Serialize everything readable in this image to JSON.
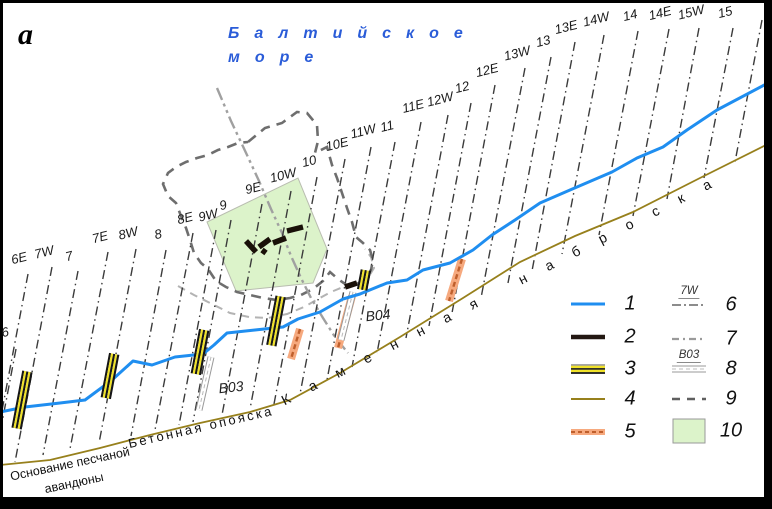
{
  "figure_label": "a",
  "sea_title": {
    "line1": "Балтийское",
    "line2": "море",
    "color": "#2a5cd8"
  },
  "map": {
    "profile_lines": [
      {
        "label": "6",
        "lx": 5,
        "ly": 332,
        "x1": 16,
        "y1": 349,
        "x2": 0,
        "y2": 433
      },
      {
        "label": "6E",
        "lx": 19,
        "ly": 258,
        "x1": 28,
        "y1": 274,
        "x2": 0,
        "y2": 421
      },
      {
        "label": "7W",
        "lx": 44,
        "ly": 252,
        "x1": 52,
        "y1": 267,
        "x2": 15,
        "y2": 462
      },
      {
        "label": "7",
        "lx": 69,
        "ly": 256,
        "x1": 78,
        "y1": 271,
        "x2": 43,
        "y2": 455
      },
      {
        "label": "7E",
        "lx": 100,
        "ly": 237,
        "x1": 108,
        "y1": 252,
        "x2": 70,
        "y2": 449
      },
      {
        "label": "8W",
        "lx": 128,
        "ly": 233,
        "x1": 136,
        "y1": 249,
        "x2": 99,
        "y2": 443
      },
      {
        "label": "8",
        "lx": 158,
        "ly": 234,
        "x1": 166,
        "y1": 250,
        "x2": 131,
        "y2": 436
      },
      {
        "label": "8E",
        "lx": 185,
        "ly": 218,
        "x1": 193,
        "y1": 233,
        "x2": 155,
        "y2": 430
      },
      {
        "label": "9W",
        "lx": 208,
        "ly": 215,
        "x1": 216,
        "y1": 230,
        "x2": 179,
        "y2": 425
      },
      {
        "label": "9",
        "lx": 223,
        "ly": 205,
        "x1": 231,
        "y1": 220,
        "x2": 193,
        "y2": 422
      },
      {
        "label": "9E",
        "lx": 253,
        "ly": 188,
        "x1": 262,
        "y1": 204,
        "x2": 222,
        "y2": 415
      },
      {
        "label": "10W",
        "lx": 283,
        "ly": 175,
        "x1": 291,
        "y1": 191,
        "x2": 250,
        "y2": 409
      },
      {
        "label": "10",
        "lx": 309,
        "ly": 161,
        "x1": 317,
        "y1": 177,
        "x2": 274,
        "y2": 404
      },
      {
        "label": "10E",
        "lx": 337,
        "ly": 144,
        "x1": 345,
        "y1": 159,
        "x2": 300,
        "y2": 394
      },
      {
        "label": "11W",
        "lx": 363,
        "ly": 131,
        "x1": 371,
        "y1": 147,
        "x2": 327,
        "y2": 380
      },
      {
        "label": "11",
        "lx": 387,
        "ly": 126,
        "x1": 395,
        "y1": 142,
        "x2": 352,
        "y2": 367
      },
      {
        "label": "11E",
        "lx": 413,
        "ly": 106,
        "x1": 421,
        "y1": 122,
        "x2": 377,
        "y2": 353
      },
      {
        "label": "12W",
        "lx": 440,
        "ly": 99,
        "x1": 448,
        "y1": 115,
        "x2": 406,
        "y2": 338
      },
      {
        "label": "12",
        "lx": 462,
        "ly": 87,
        "x1": 471,
        "y1": 103,
        "x2": 429,
        "y2": 326
      },
      {
        "label": "12E",
        "lx": 487,
        "ly": 70,
        "x1": 495,
        "y1": 85,
        "x2": 452,
        "y2": 313
      },
      {
        "label": "13W",
        "lx": 517,
        "ly": 53,
        "x1": 525,
        "y1": 68,
        "x2": 481,
        "y2": 298
      },
      {
        "label": "13",
        "lx": 543,
        "ly": 41,
        "x1": 551,
        "y1": 57,
        "x2": 508,
        "y2": 283
      },
      {
        "label": "13E",
        "lx": 566,
        "ly": 27,
        "x1": 575,
        "y1": 42,
        "x2": 532,
        "y2": 271
      },
      {
        "label": "14W",
        "lx": 596,
        "ly": 19,
        "x1": 604,
        "y1": 35,
        "x2": 562,
        "y2": 254
      },
      {
        "label": "14",
        "lx": 630,
        "ly": 15,
        "x1": 638,
        "y1": 31,
        "x2": 599,
        "y2": 235
      },
      {
        "label": "14E",
        "lx": 660,
        "ly": 13,
        "x1": 669,
        "y1": 29,
        "x2": 633,
        "y2": 216
      },
      {
        "label": "15W",
        "lx": 691,
        "ly": 12,
        "x1": 699,
        "y1": 28,
        "x2": 667,
        "y2": 199
      },
      {
        "label": "15",
        "lx": 725,
        "ly": 12,
        "x1": 733,
        "y1": 28,
        "x2": 704,
        "y2": 178
      },
      {
        "label": "",
        "lx": 762,
        "ly": 8,
        "x1": 762,
        "y1": 20,
        "x2": 735,
        "y2": 162
      }
    ],
    "blue_line": [
      [
        0,
        412
      ],
      [
        25,
        407
      ],
      [
        60,
        403
      ],
      [
        85,
        400
      ],
      [
        112,
        380
      ],
      [
        133,
        361
      ],
      [
        152,
        365
      ],
      [
        175,
        357
      ],
      [
        203,
        354
      ],
      [
        214,
        345
      ],
      [
        227,
        333
      ],
      [
        255,
        330
      ],
      [
        283,
        327
      ],
      [
        298,
        319
      ],
      [
        320,
        312
      ],
      [
        343,
        299
      ],
      [
        360,
        294
      ],
      [
        387,
        283
      ],
      [
        407,
        280
      ],
      [
        423,
        270
      ],
      [
        450,
        263
      ],
      [
        473,
        250
      ],
      [
        492,
        235
      ],
      [
        515,
        220
      ],
      [
        540,
        203
      ],
      [
        570,
        190
      ],
      [
        612,
        172
      ],
      [
        637,
        158
      ],
      [
        663,
        147
      ],
      [
        687,
        130
      ],
      [
        717,
        110
      ],
      [
        770,
        82
      ]
    ],
    "olive_line": [
      [
        0,
        465
      ],
      [
        50,
        460
      ],
      [
        100,
        448
      ],
      [
        150,
        435
      ],
      [
        200,
        423
      ],
      [
        250,
        412
      ],
      [
        290,
        400
      ],
      [
        340,
        373
      ],
      [
        400,
        337
      ],
      [
        463,
        298
      ],
      [
        520,
        262
      ],
      [
        575,
        236
      ],
      [
        633,
        212
      ],
      [
        700,
        178
      ],
      [
        770,
        143
      ]
    ],
    "gray_center_line": [
      [
        217,
        88
      ],
      [
        231,
        121
      ],
      [
        247,
        155
      ],
      [
        259,
        181
      ],
      [
        271,
        209
      ],
      [
        282,
        233
      ],
      [
        291,
        256
      ],
      [
        301,
        278
      ],
      [
        311,
        298
      ],
      [
        323,
        318
      ],
      [
        335,
        337
      ],
      [
        348,
        353
      ]
    ],
    "dashed_loop": [
      [
        248,
        142
      ],
      [
        265,
        128
      ],
      [
        282,
        123
      ],
      [
        297,
        112
      ],
      [
        307,
        113
      ],
      [
        317,
        125
      ],
      [
        318,
        141
      ],
      [
        315,
        153
      ],
      [
        327,
        147
      ],
      [
        332,
        165
      ],
      [
        337,
        178
      ],
      [
        342,
        193
      ],
      [
        347,
        208
      ],
      [
        352,
        222
      ],
      [
        356,
        237
      ],
      [
        363,
        243
      ],
      [
        370,
        250
      ],
      [
        373,
        260
      ],
      [
        371,
        270
      ],
      [
        366,
        278
      ],
      [
        357,
        284
      ],
      [
        348,
        286
      ],
      [
        338,
        279
      ],
      [
        330,
        272
      ],
      [
        323,
        281
      ],
      [
        313,
        289
      ],
      [
        301,
        295
      ],
      [
        290,
        298
      ],
      [
        277,
        300
      ],
      [
        263,
        298
      ],
      [
        250,
        295
      ],
      [
        237,
        292
      ],
      [
        226,
        287
      ],
      [
        216,
        281
      ],
      [
        208,
        269
      ],
      [
        201,
        263
      ],
      [
        194,
        253
      ],
      [
        190,
        240
      ],
      [
        186,
        228
      ],
      [
        181,
        216
      ],
      [
        176,
        203
      ],
      [
        168,
        196
      ],
      [
        163,
        184
      ],
      [
        168,
        173
      ],
      [
        176,
        167
      ],
      [
        186,
        162
      ],
      [
        197,
        158
      ],
      [
        208,
        155
      ],
      [
        218,
        150
      ],
      [
        228,
        147
      ],
      [
        238,
        143
      ],
      [
        248,
        142
      ]
    ],
    "light_dashed_line": [
      [
        178,
        286
      ],
      [
        194,
        295
      ],
      [
        212,
        304
      ],
      [
        230,
        313
      ],
      [
        249,
        317
      ],
      [
        268,
        318
      ],
      [
        287,
        314
      ],
      [
        304,
        307
      ],
      [
        318,
        299
      ],
      [
        331,
        292
      ],
      [
        343,
        287
      ],
      [
        356,
        283
      ],
      [
        368,
        278
      ],
      [
        374,
        268
      ],
      [
        371,
        257
      ],
      [
        365,
        249
      ]
    ],
    "green_polygon": [
      [
        207,
        222
      ],
      [
        298,
        178
      ],
      [
        327,
        249
      ],
      [
        313,
        283
      ],
      [
        236,
        291
      ]
    ],
    "black_dashes": [
      [
        246,
        241,
        256,
        252
      ],
      [
        259,
        247,
        270,
        239
      ],
      [
        262,
        250,
        266,
        253
      ],
      [
        273,
        243,
        286,
        238
      ],
      [
        287,
        231,
        303,
        227
      ],
      [
        345,
        287,
        357,
        283
      ]
    ],
    "striped_markers": [
      {
        "cx": 22,
        "cy": 400,
        "len": 58
      },
      {
        "cx": 110,
        "cy": 376,
        "len": 45
      },
      {
        "cx": 200,
        "cy": 352,
        "len": 45
      },
      {
        "cx": 276,
        "cy": 321,
        "len": 50
      },
      {
        "cx": 364,
        "cy": 280,
        "len": 20
      }
    ],
    "orange_bands": [
      {
        "x1": 300,
        "y1": 329,
        "x2": 291,
        "y2": 359
      },
      {
        "x1": 352,
        "y1": 296,
        "x2": 338,
        "y2": 348
      },
      {
        "x1": 462,
        "y1": 259,
        "x2": 449,
        "y2": 301
      }
    ],
    "boreholes": [
      {
        "x1": 211,
        "y1": 357,
        "x2": 199,
        "y2": 410,
        "label": "B03",
        "label_x": 231,
        "label_y": 387
      },
      {
        "x1": 353,
        "y1": 292,
        "x2": 341,
        "y2": 340,
        "label": "B04",
        "label_x": 378,
        "label_y": 315
      }
    ],
    "coast_labels": [
      {
        "id": "kamennaya-label",
        "text": "Каменная наброска",
        "cx": 506,
        "cy": 287,
        "rotate": -27,
        "spacing": 22,
        "size": 14
      },
      {
        "id": "betonnaya-label",
        "text": "Бетонная опояска",
        "cx": 201,
        "cy": 427,
        "rotate": -13,
        "spacing": 2.5,
        "size": 13
      },
      {
        "id": "osnovanie-label-1",
        "text": "Основание песчаной",
        "cx": 70,
        "cy": 464,
        "rotate": -12,
        "spacing": 0,
        "size": 12.5
      },
      {
        "id": "osnovanie-label-2",
        "text": "авандюны",
        "cx": 74,
        "cy": 483,
        "rotate": -12,
        "spacing": 0,
        "size": 12.5
      }
    ]
  },
  "legend": {
    "items": [
      {
        "num": "1",
        "type": "blue-line",
        "x": 588,
        "y": 304
      },
      {
        "num": "2",
        "type": "black-dash",
        "x": 588,
        "y": 337
      },
      {
        "num": "3",
        "type": "striped-band",
        "x": 588,
        "y": 369
      },
      {
        "num": "4",
        "type": "olive-line",
        "x": 588,
        "y": 399
      },
      {
        "num": "5",
        "type": "orange-band",
        "x": 588,
        "y": 432
      },
      {
        "num": "6",
        "type": "profile-line",
        "sublabel": "7W",
        "x": 689,
        "y": 305
      },
      {
        "num": "7",
        "type": "gray-dashed",
        "x": 689,
        "y": 339
      },
      {
        "num": "8",
        "type": "borehole",
        "sublabel": "B03",
        "x": 689,
        "y": 369
      },
      {
        "num": "9",
        "type": "dark-dashed",
        "x": 689,
        "y": 399
      },
      {
        "num": "10",
        "type": "green-area",
        "x": 689,
        "y": 431
      }
    ]
  },
  "colors": {
    "sea_line": "#1f8ef0",
    "rock_line": "#97801c",
    "profile_line": "#3b3b3b",
    "loop": "#6e6e6e",
    "light_dashed": "#b3b3b3",
    "gray_center": "#a0a0a0",
    "green_fill": "#dcf3ca",
    "green_stroke": "#b9bdb0",
    "orange_fill": "#f6a97e",
    "orange_dash": "#bf5f2c",
    "marker_yellow": "#f0e229",
    "marker_black": "#161616",
    "black_dash": "#191008",
    "borehole_stroke": "#999999",
    "frame": "#000000"
  }
}
